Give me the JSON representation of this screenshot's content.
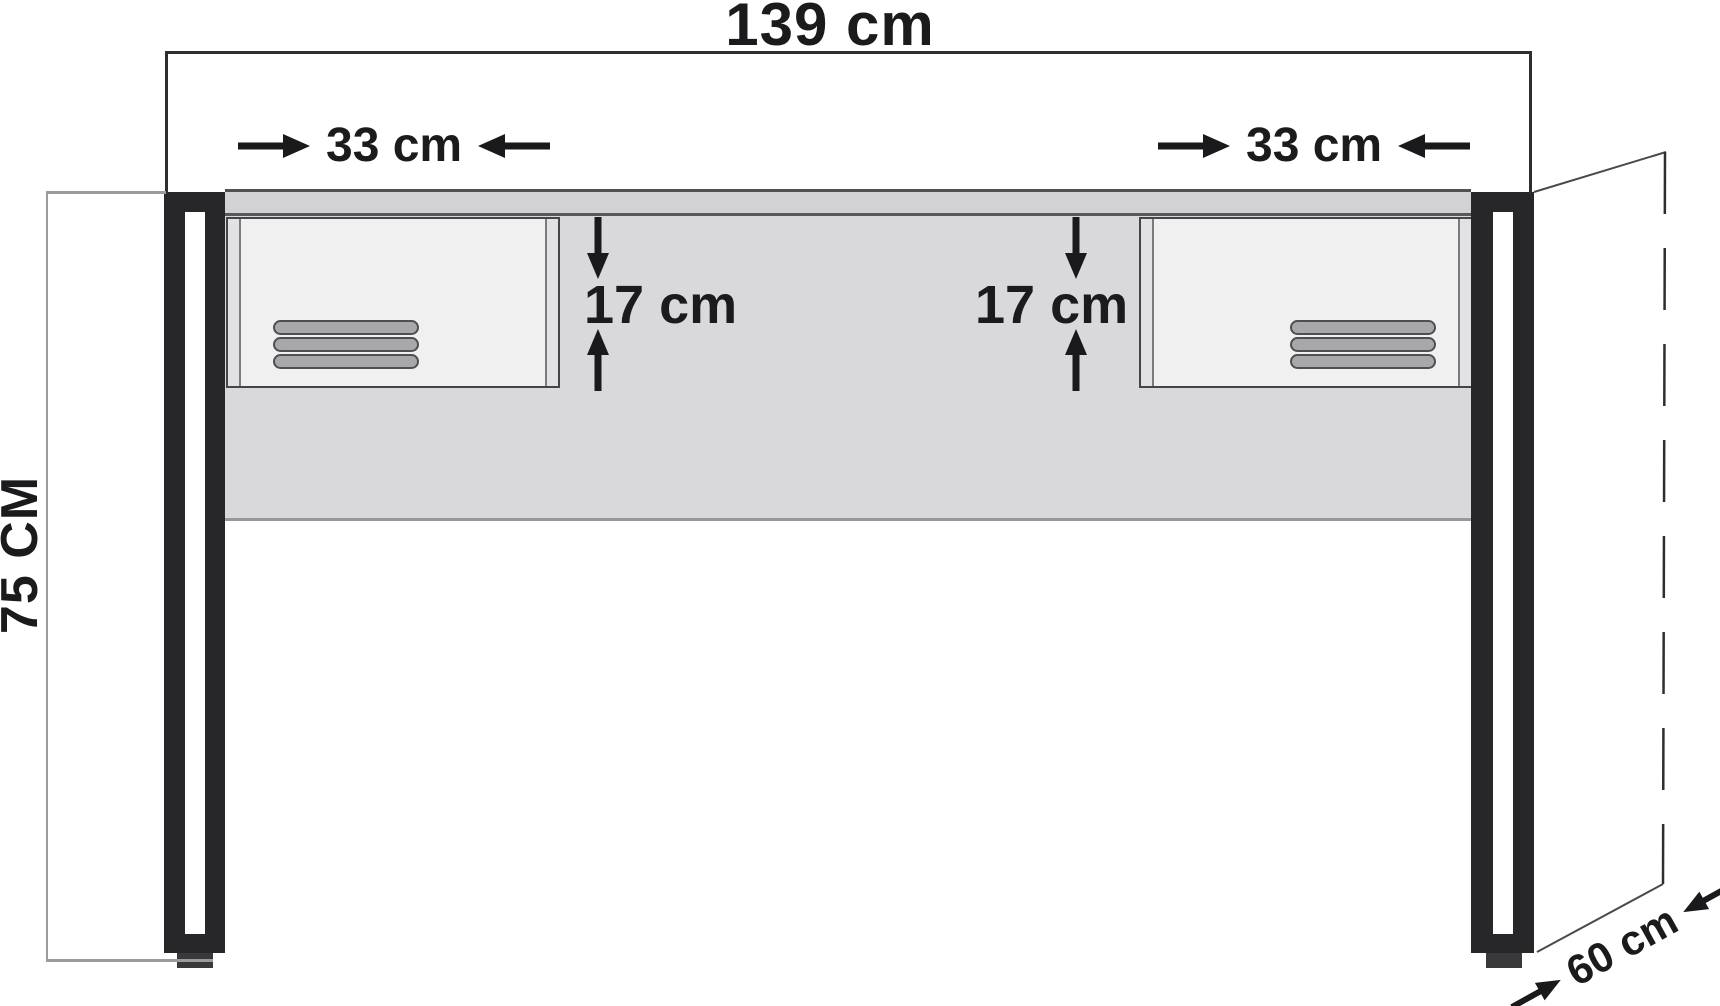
{
  "diagram": {
    "subject": "console-desk-dimension-drawing",
    "dimensions": {
      "overall_width": "139 cm",
      "left_drawer_width": "33 cm",
      "right_drawer_width": "33 cm",
      "left_drawer_height": "17 cm",
      "right_drawer_height": "17 cm",
      "overall_height": "75 CM",
      "depth": "60 cm"
    },
    "colors": {
      "background": "#ffffff",
      "leg": "#272729",
      "desk_top_edge": "#d2d2d4",
      "back_panel": "#d9d9db",
      "drawer_front": "#f0f0f1",
      "drawer_side_strip": "#e2e2e4",
      "vent_slot": "#a8a8ab",
      "dimension_ink": "#1a1a1c",
      "light_guide_line": "#9b9b9e"
    }
  }
}
